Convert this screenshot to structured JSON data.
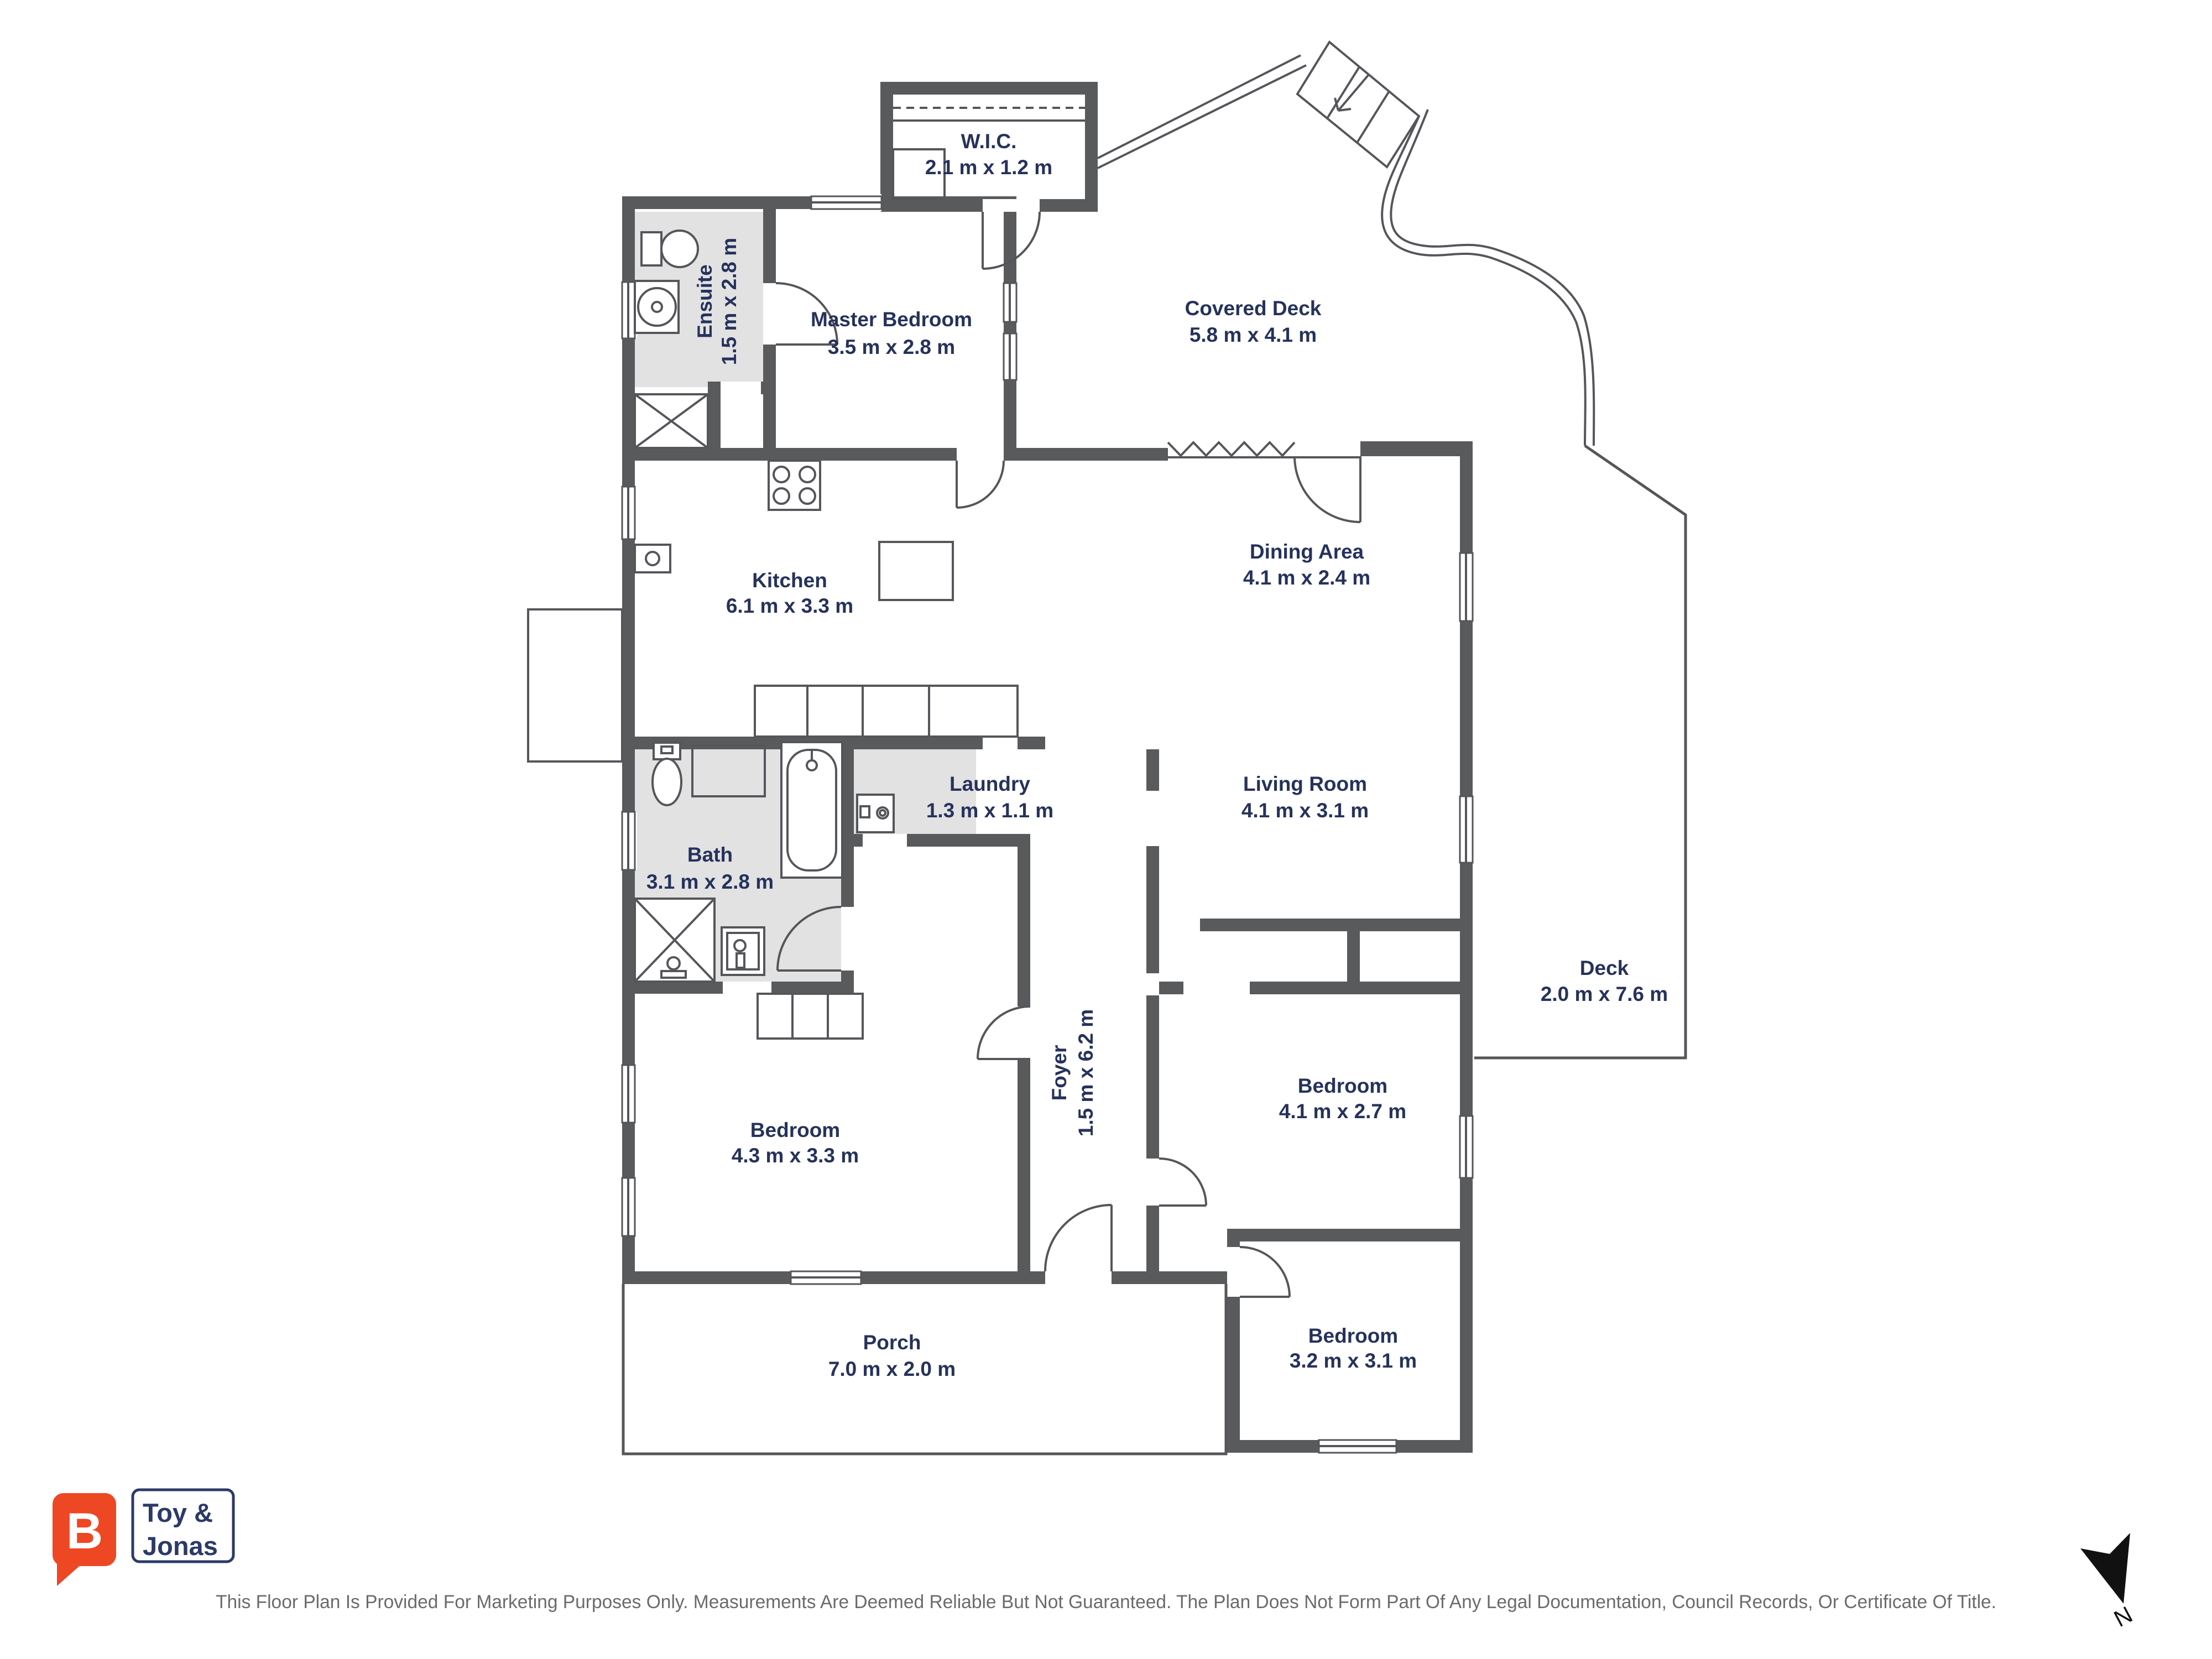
{
  "rooms": [
    {
      "name": "W.I.C.",
      "dims": "2.1 m x 1.2 m"
    },
    {
      "name": "Master Bedroom",
      "dims": "3.5 m x 2.8 m"
    },
    {
      "name": "Covered Deck",
      "dims": "5.8 m x 4.1 m"
    },
    {
      "name": "Ensuite",
      "dims": "1.5 m x 2.8 m"
    },
    {
      "name": "Kitchen",
      "dims": "6.1 m x 3.3 m"
    },
    {
      "name": "Dining Area",
      "dims": "4.1 m x 2.4 m"
    },
    {
      "name": "Living Room",
      "dims": "4.1 m x 3.1 m"
    },
    {
      "name": "Laundry",
      "dims": "1.3 m x 1.1 m"
    },
    {
      "name": "Bath",
      "dims": "3.1 m x 2.8 m"
    },
    {
      "name": "Foyer",
      "dims": "1.5 m x 6.2 m"
    },
    {
      "name": "Deck",
      "dims": "2.0 m x 7.6 m"
    },
    {
      "name": "Bedroom",
      "dims": "4.1 m x 2.7 m"
    },
    {
      "name": "Bedroom",
      "dims": "4.3 m x 3.3 m"
    },
    {
      "name": "Bedroom",
      "dims": "3.2 m x 3.1 m"
    },
    {
      "name": "Porch",
      "dims": "7.0 m x 2.0 m"
    }
  ],
  "logo": {
    "brand_initial": "B",
    "line1": "Toy &",
    "line2": "Jonas",
    "bubble_color": "#ee4723",
    "text_color": "#2b3a68"
  },
  "footer": {
    "disclaimer": "This Floor Plan Is Provided For Marketing Purposes Only. Measurements Are Deemed Reliable But Not Guaranteed. The Plan Does Not Form Part Of Any Legal Documentation, Council Records, Or Certificate Of Title."
  },
  "compass": {
    "label": "N"
  },
  "colors": {
    "wall": "#595a5c",
    "shaded_floor": "#e2e2e3",
    "label_text": "#26325c",
    "disclaimer_text": "#6b6b6b",
    "north_arrow": "#111111"
  }
}
